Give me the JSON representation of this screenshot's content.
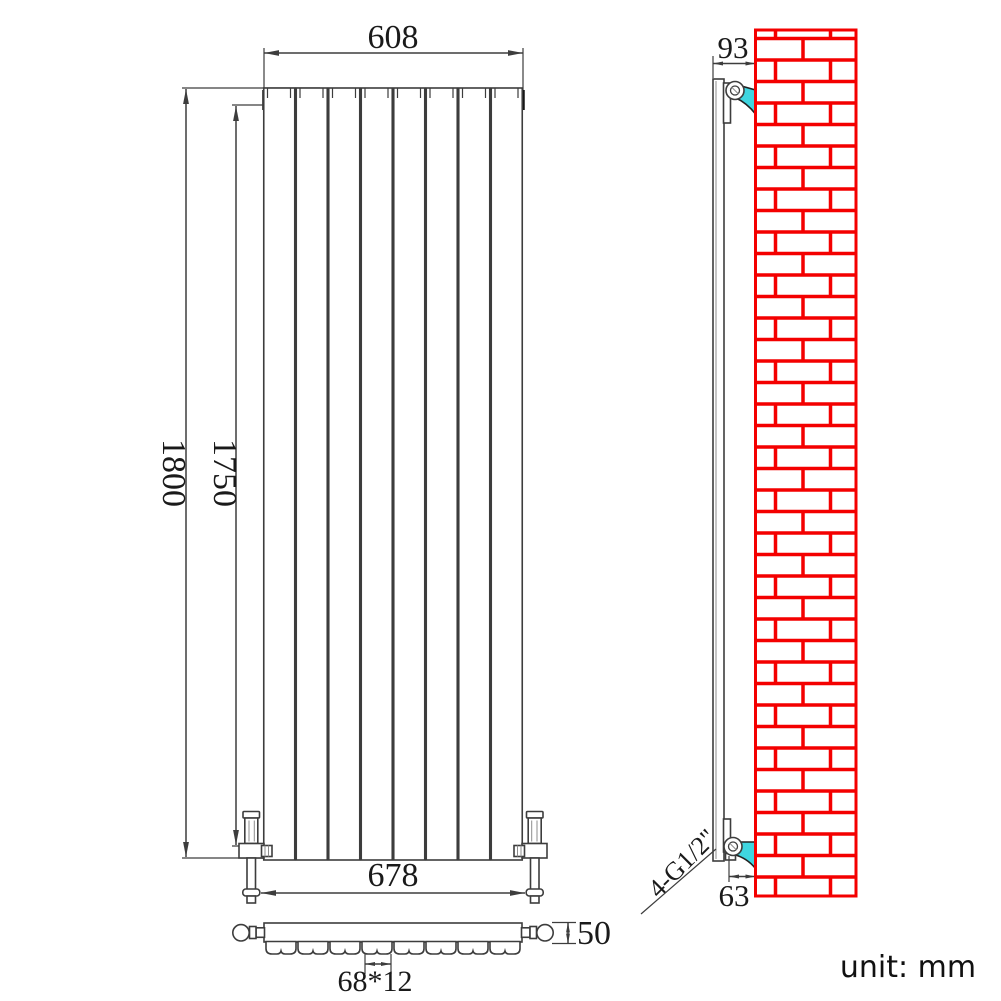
{
  "drawing": {
    "front_view": {
      "width_label": "608",
      "overall_height_label": "1800",
      "pipe_center_height_label": "1750",
      "valve_span_label": "678",
      "panel_count": 8
    },
    "plan_view": {
      "depth_label": "50",
      "panel_pitch_label": "68*12"
    },
    "side_view": {
      "wall_offset_top_label": "93",
      "wall_offset_bottom_label": "63",
      "connection_label": "4-G1/2\""
    },
    "unit_label": "unit: mm",
    "colors": {
      "line": "#3d3d3d",
      "brick_red": "#f40000",
      "bracket_cyan": "#3fd6e0",
      "hidden_dash": "#949494"
    }
  }
}
